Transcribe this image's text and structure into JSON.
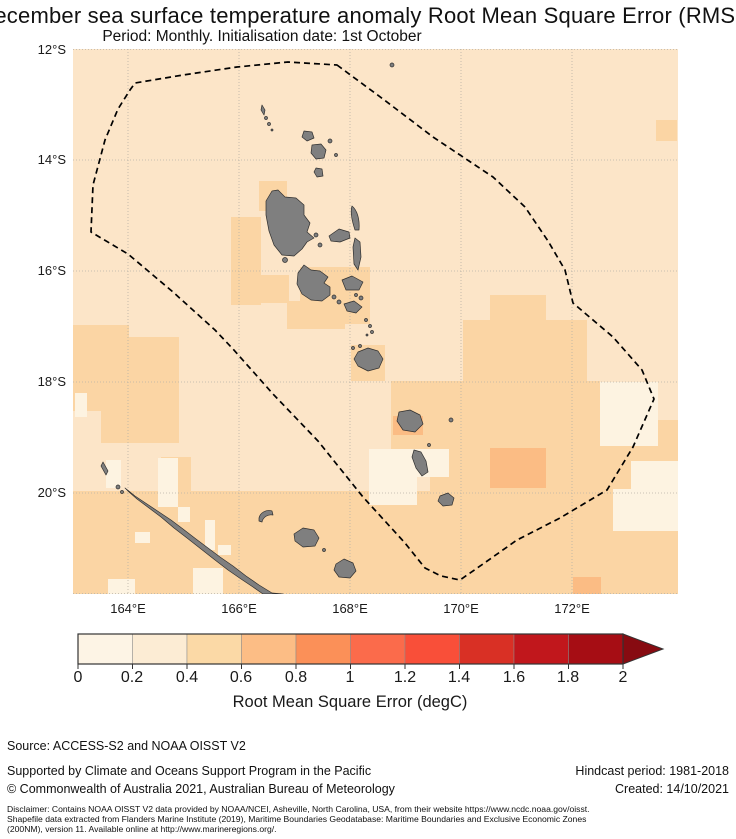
{
  "title": {
    "line1": "December sea surface temperature anomaly Root Mean Square Error (RMSE)",
    "line2": "Period: Monthly. Initialisation date: 1st October"
  },
  "map": {
    "lat_ticks": [
      "12°S",
      "14°S",
      "16°S",
      "18°S",
      "20°S"
    ],
    "lon_ticks": [
      "164°E",
      "166°E",
      "168°E",
      "170°E",
      "172°E"
    ],
    "colors": {
      "bin1": "#fdf3e1",
      "bin2": "#fce5c8",
      "bin3": "#fbd5a4",
      "bin4": "#fbbc84",
      "island": "#7f7f7f",
      "eez": "#000000",
      "gridline": "#b8b2a6"
    },
    "legend_note": "dashed line = EEZ maritime boundary; grey = land"
  },
  "colorbar": {
    "label": "Root Mean Square Error (degC)",
    "ticks": [
      "0",
      "0.2",
      "0.4",
      "0.6",
      "0.8",
      "1",
      "1.2",
      "1.4",
      "1.6",
      "1.8",
      "2"
    ],
    "range": [
      0,
      2
    ],
    "segment_colors": [
      "#fdf4e5",
      "#fcecd4",
      "#fbd9a6",
      "#fcbd85",
      "#fb9058",
      "#fb6b4b",
      "#f94f39",
      "#d93025",
      "#c1171c",
      "#a60d14"
    ],
    "arrow_color": "#870b11"
  },
  "footer": {
    "source": "Source: ACCESS-S2 and NOAA OISST V2",
    "supported": "Supported by Climate and Oceans Support Program in the Pacific",
    "copyright": "© Commonwealth of Australia 2021, Australian Bureau of Meteorology",
    "hindcast": "Hindcast period: 1981-2018",
    "created": "Created: 14/10/2021",
    "disclaimer_lines": [
      "Disclaimer: Contains NOAA OISST V2 data provided by NOAA/NCEI, Asheville, North Carolina, USA, from their website https://www.ncdc.noaa.gov/oisst.",
      "Shapefile data extracted from Flanders Marine Institute (2019), Maritime Boundaries Geodatabase: Maritime Boundaries and Exclusive Economic Zones",
      "(200NM), version 11. Available online at http://www.marineregions.org/."
    ]
  }
}
